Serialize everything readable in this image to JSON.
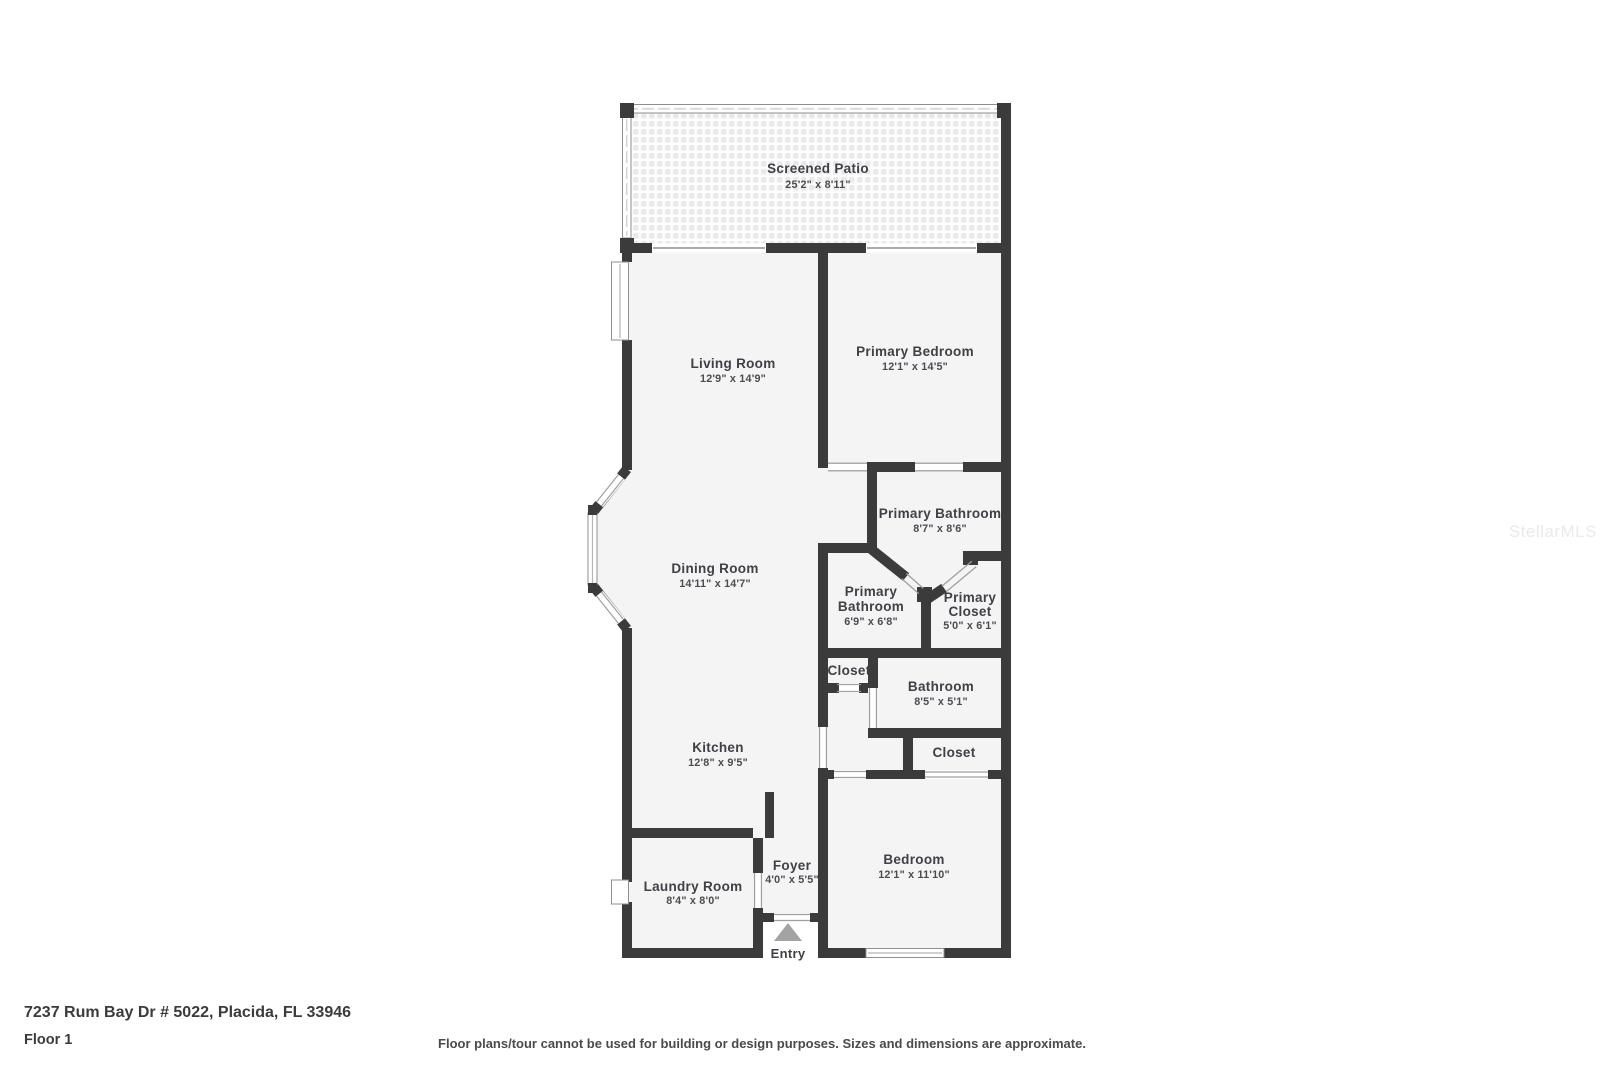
{
  "rooms": {
    "screened_patio": {
      "name": "Screened Patio",
      "dims": "25'2\" x 8'11\""
    },
    "living_room": {
      "name": "Living Room",
      "dims": "12'9\" x 14'9\""
    },
    "primary_bedroom": {
      "name": "Primary Bedroom",
      "dims": "12'1\" x 14'5\""
    },
    "primary_bathroom_main": {
      "name": "Primary Bathroom",
      "dims": "8'7\" x 8'6\""
    },
    "dining_room": {
      "name": "Dining Room",
      "dims": "14'11\" x 14'7\""
    },
    "primary_bathroom_small": {
      "line1": "Primary",
      "line2": "Bathroom",
      "dims": "6'9\" x 6'8\""
    },
    "primary_closet": {
      "line1": "Primary",
      "line2": "Closet",
      "dims": "5'0\" x 6'1\""
    },
    "closet_hall": {
      "name": "Closet"
    },
    "bathroom": {
      "name": "Bathroom",
      "dims": "8'5\" x 5'1\""
    },
    "kitchen": {
      "name": "Kitchen",
      "dims": "12'8\" x 9'5\""
    },
    "closet_bedroom": {
      "name": "Closet"
    },
    "bedroom": {
      "name": "Bedroom",
      "dims": "12'1\" x 11'10\""
    },
    "laundry_room": {
      "name": "Laundry Room",
      "dims": "8'4\" x 8'0\""
    },
    "foyer": {
      "name": "Foyer",
      "dims": "4'0\" x 5'5\""
    }
  },
  "entry": {
    "label": "Entry"
  },
  "footer": {
    "address": "7237 Rum Bay Dr # 5022, Placida, FL 33946",
    "floor": "Floor 1",
    "disclaimer": "Floor plans/tour cannot be used for building or design purposes. Sizes and dimensions are approximate."
  },
  "watermark": "StellarMLS",
  "colors": {
    "wall": "#3b3b3b",
    "room_fill": "#f4f4f4",
    "entry_arrow": "#a3a3a3"
  }
}
